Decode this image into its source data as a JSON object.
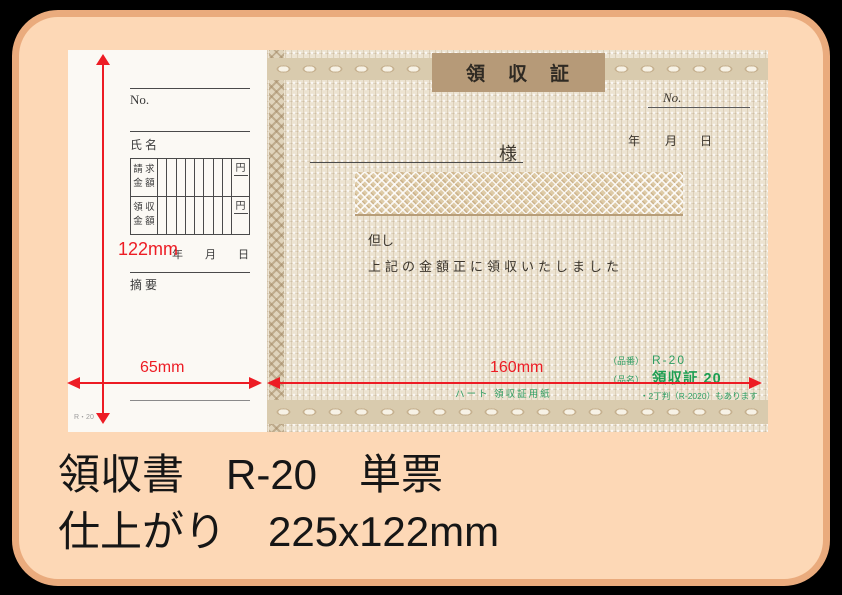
{
  "colors": {
    "accent_red": "#ed1c24",
    "product_green": "#2f9e63",
    "title_box_tan": "#b69a78",
    "card_background": "#fdd8b6",
    "card_border": "#eaab7d"
  },
  "caption": {
    "line1": "領収書　R-20　単票",
    "line2": "仕上がり　225x122mm"
  },
  "dimensions": {
    "height": "122mm",
    "stub_width": "65mm",
    "body_width": "160mm"
  },
  "stub": {
    "no_label": "No.",
    "name_label": "氏 名",
    "billing_line1": "請 求",
    "billing_line2": "金 額",
    "received_line1": "領 収",
    "received_line2": "金 額",
    "yen1": "円",
    "yen2": "円",
    "year": "年",
    "month": "月",
    "day": "日",
    "remarks_label": "摘 要",
    "form_code": "R・20"
  },
  "receipt": {
    "title": "領　収　証",
    "no_label": "No.",
    "year": "年",
    "month": "月",
    "day": "日",
    "honorific": "様",
    "proviso": "但し",
    "statement": "上記の金額正に領収いたしました",
    "product_number_label": "（品番）",
    "product_number": "R-20",
    "product_name_label": "（品名）",
    "product_name": "領収証 20",
    "variant_note": "・2丁判（R-2020）もあります",
    "paper_note": "ハート 領収証用紙"
  }
}
